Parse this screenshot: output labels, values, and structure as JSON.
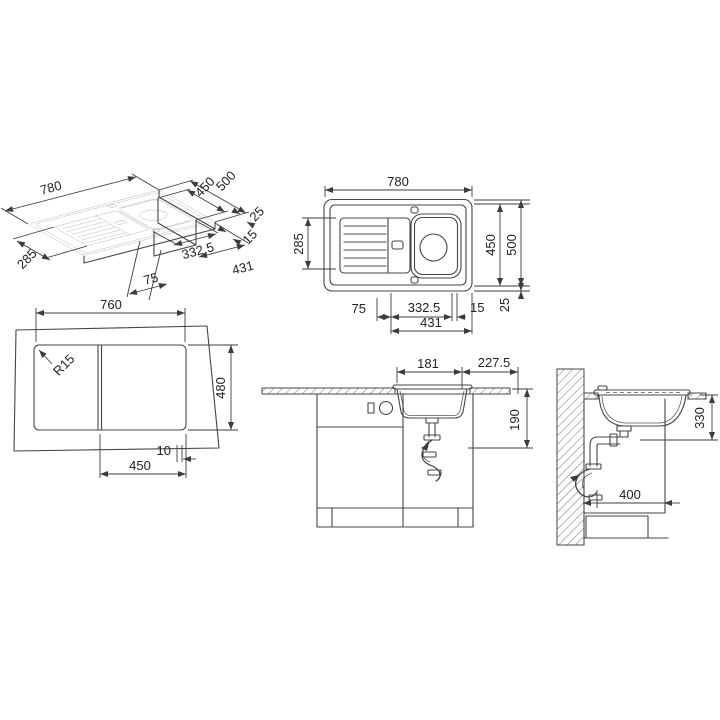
{
  "page": {
    "background": "#ffffff",
    "line_color": "#454545",
    "text_color": "#222222"
  },
  "views": {
    "iso": {
      "d780": "780",
      "d500": "500",
      "d450": "450",
      "d25": "25",
      "d15": "15",
      "d285": "285",
      "d332": "332,5",
      "d75": "75",
      "d431": "431"
    },
    "plan": {
      "d780": "780",
      "d285": "285",
      "d450": "450",
      "d500": "500",
      "d75": "75",
      "d332": "332.5",
      "d15": "15",
      "d25": "25",
      "d431": "431"
    },
    "cutout": {
      "d760": "760",
      "r15": "R15",
      "d480": "480",
      "d10": "10",
      "d450": "450"
    },
    "front": {
      "d181": "181",
      "d2275": "227.5",
      "d190": "190"
    },
    "side": {
      "d330": "330",
      "d400": "400"
    }
  }
}
